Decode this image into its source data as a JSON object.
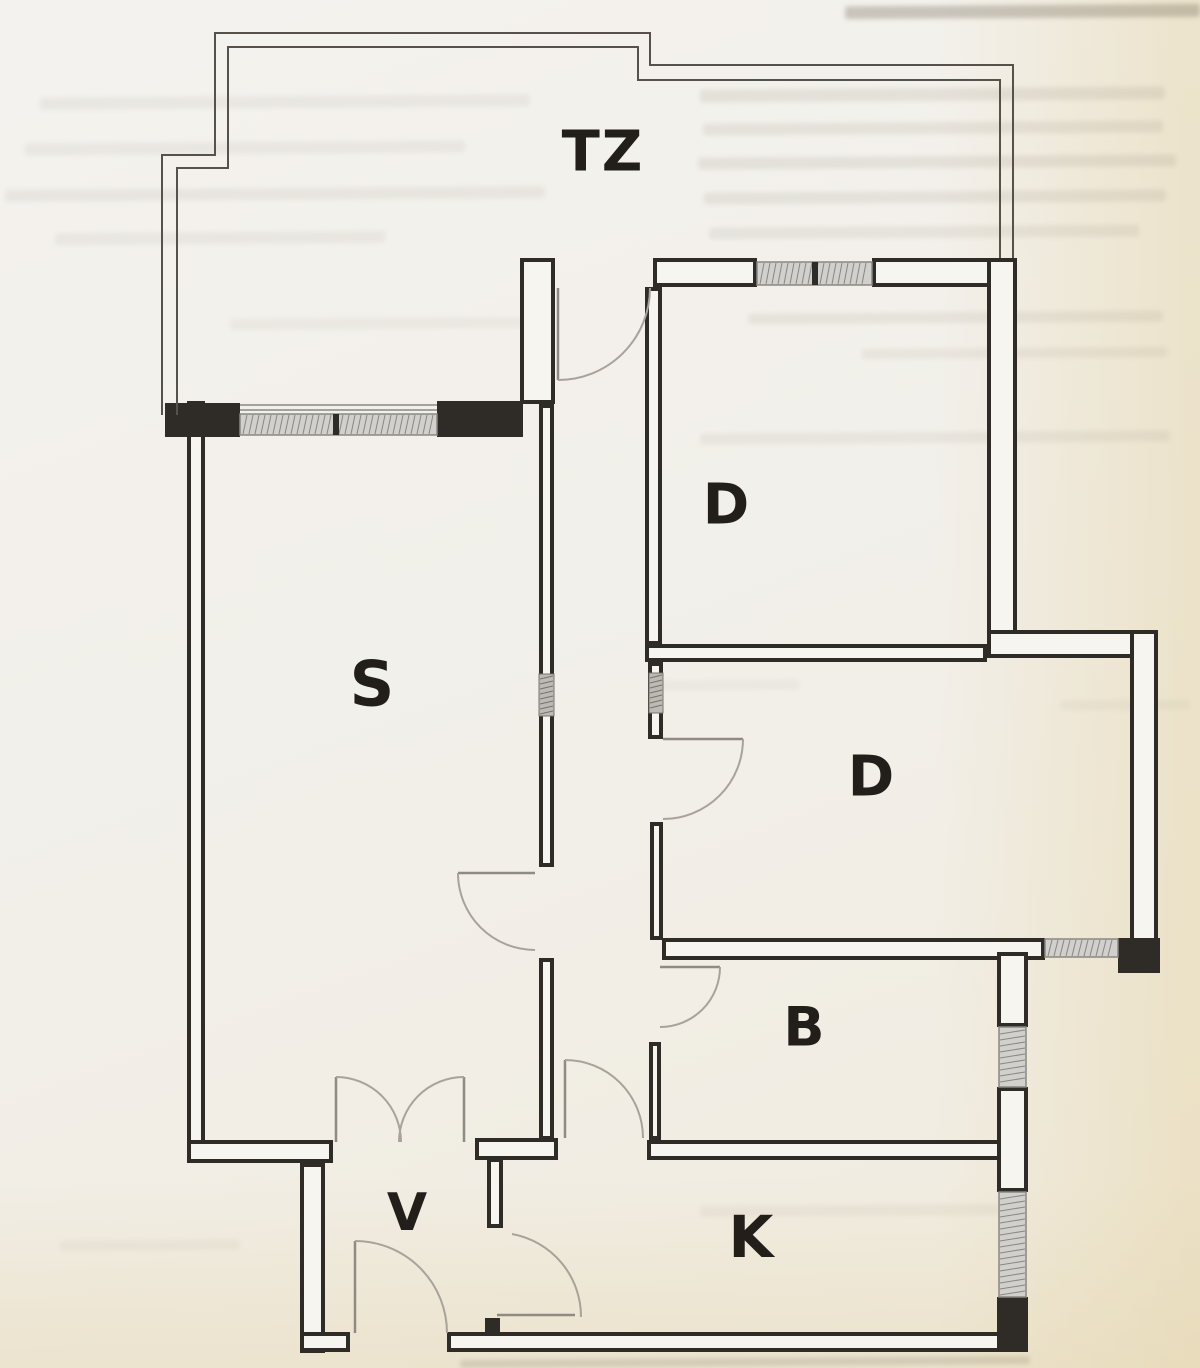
{
  "document": {
    "kind_note": "scanned architectural floor plan, black ink on aged paper"
  },
  "palette": {
    "wall_line": "#2f2c28",
    "wall_core": "#f7f5f0",
    "thin_line": "#56524b",
    "arc_line": "#a8a39a",
    "leaf_line": "#8f8b84",
    "hatch_fill": "#d2d0cc",
    "hatch_edge": "#8a8781",
    "shaft_fill": "#bdbab5",
    "shaft_edge": "#76726b",
    "label_color": "#221f1b"
  },
  "rooms": [
    {
      "id": "tz",
      "label": "TZ",
      "x": 603,
      "y": 152,
      "size": 56
    },
    {
      "id": "s",
      "label": "S",
      "x": 373,
      "y": 684,
      "size": 62
    },
    {
      "id": "d-upper",
      "label": "D",
      "x": 727,
      "y": 505,
      "size": 56
    },
    {
      "id": "d-middle",
      "label": "D",
      "x": 872,
      "y": 777,
      "size": 56
    },
    {
      "id": "b",
      "label": "B",
      "x": 805,
      "y": 1027,
      "size": 54
    },
    {
      "id": "v",
      "label": "V",
      "x": 408,
      "y": 1213,
      "size": 52
    },
    {
      "id": "k",
      "label": "K",
      "x": 752,
      "y": 1237,
      "size": 58
    }
  ],
  "floorplan": {
    "thin_outlines": [
      [
        [
          162,
          415
        ],
        [
          162,
          155
        ],
        [
          215,
          155
        ],
        [
          215,
          33
        ],
        [
          650,
          33
        ],
        [
          650,
          65
        ],
        [
          1013,
          65
        ],
        [
          1013,
          258
        ]
      ],
      [
        [
          177,
          415
        ],
        [
          177,
          168
        ],
        [
          228,
          168
        ],
        [
          228,
          47
        ],
        [
          638,
          47
        ],
        [
          638,
          80
        ],
        [
          1000,
          80
        ],
        [
          1000,
          258
        ]
      ]
    ],
    "walls_hollow": [
      [
        187,
        401,
        18,
        762
      ],
      [
        653,
        258,
        104,
        29
      ],
      [
        872,
        258,
        145,
        29
      ],
      [
        520,
        258,
        35,
        146
      ],
      [
        539,
        404,
        15,
        463
      ],
      [
        539,
        958,
        15,
        182
      ],
      [
        987,
        258,
        30,
        390
      ],
      [
        645,
        287,
        17,
        358
      ],
      [
        645,
        644,
        342,
        18
      ],
      [
        987,
        630,
        171,
        28
      ],
      [
        1130,
        630,
        28,
        343
      ],
      [
        662,
        938,
        383,
        22
      ],
      [
        648,
        662,
        15,
        77
      ],
      [
        650,
        822,
        13,
        118
      ],
      [
        649,
        1042,
        12,
        98
      ],
      [
        475,
        1138,
        83,
        22
      ],
      [
        647,
        1140,
        365,
        20
      ],
      [
        487,
        1158,
        16,
        70
      ],
      [
        997,
        952,
        31,
        75
      ],
      [
        997,
        1087,
        31,
        105
      ],
      [
        187,
        1140,
        146,
        23
      ],
      [
        300,
        1163,
        25,
        190
      ],
      [
        300,
        1332,
        50,
        20
      ],
      [
        447,
        1332,
        581,
        20
      ]
    ],
    "walls_solid": [
      [
        165,
        403,
        75,
        34
      ],
      [
        437,
        401,
        86,
        36
      ],
      [
        1118,
        938,
        42,
        35
      ],
      [
        485,
        1318,
        15,
        16
      ],
      [
        997,
        1297,
        31,
        55
      ]
    ],
    "windows": [
      {
        "rect": [
          240,
          414,
          197,
          21
        ],
        "dividers": [
          333
        ],
        "sills": [
          [
            240,
            405,
            437,
            405
          ],
          [
            240,
            410,
            437,
            410
          ]
        ]
      },
      {
        "rect": [
          757,
          262,
          115,
          23
        ],
        "dividers": [
          812
        ],
        "sills": []
      },
      {
        "rect": [
          1045,
          939,
          73,
          18
        ],
        "dividers": [],
        "sills": []
      },
      {
        "rect": [
          999,
          1027,
          27,
          60
        ],
        "dividers": [],
        "sills": []
      },
      {
        "rect": [
          999,
          1192,
          27,
          105
        ],
        "dividers": [],
        "sills": []
      }
    ],
    "shafts": [
      [
        539,
        674,
        15,
        42
      ],
      [
        649,
        673,
        14,
        40
      ]
    ],
    "door_leaves": [
      [
        558,
        288,
        558,
        380
      ],
      [
        663,
        739,
        743,
        739
      ],
      [
        660,
        967,
        720,
        967
      ],
      [
        535,
        873,
        458,
        873
      ],
      [
        565,
        1138,
        565,
        1060
      ],
      [
        497,
        1315,
        575,
        1315
      ],
      [
        355,
        1333,
        355,
        1241
      ],
      [
        336,
        1142,
        336,
        1077
      ],
      [
        464,
        1142,
        464,
        1077
      ]
    ],
    "door_arcs": [
      "M650,288 A92,92 0 0 1 558,380",
      "M743,739 A80,80 0 0 1 663,819",
      "M720,967 A60,60 0 0 1 660,1027",
      "M458,873 A77,77 0 0 0 535,950",
      "M565,1060 A78,78 0 0 1 643,1138",
      "M512,1234 A84,84 0 0 1 581,1317",
      "M355,1241 A92,92 0 0 1 447,1333",
      "M336,1077 A65,65 0 0 1 401,1142",
      "M464,1077 A65,65 0 0 0 399,1142"
    ]
  },
  "bleed_artifacts": [
    [
      845,
      5,
      355,
      13,
      0.3
    ],
    [
      700,
      88,
      465,
      13,
      0.11
    ],
    [
      703,
      122,
      460,
      12,
      0.1
    ],
    [
      698,
      156,
      478,
      12,
      0.11
    ],
    [
      704,
      191,
      462,
      12,
      0.1
    ],
    [
      709,
      226,
      430,
      12,
      0.09
    ],
    [
      748,
      312,
      415,
      11,
      0.09
    ],
    [
      862,
      348,
      305,
      10,
      0.08
    ],
    [
      700,
      432,
      470,
      11,
      0.08
    ],
    [
      40,
      96,
      490,
      12,
      0.07
    ],
    [
      25,
      142,
      440,
      12,
      0.07
    ],
    [
      5,
      188,
      540,
      12,
      0.08
    ],
    [
      55,
      232,
      330,
      12,
      0.07
    ],
    [
      230,
      318,
      300,
      11,
      0.06
    ],
    [
      660,
      680,
      140,
      10,
      0.05
    ],
    [
      1060,
      700,
      130,
      10,
      0.05
    ],
    [
      700,
      1205,
      300,
      11,
      0.06
    ],
    [
      60,
      1240,
      180,
      10,
      0.05
    ],
    [
      460,
      1358,
      570,
      8,
      0.18
    ]
  ]
}
